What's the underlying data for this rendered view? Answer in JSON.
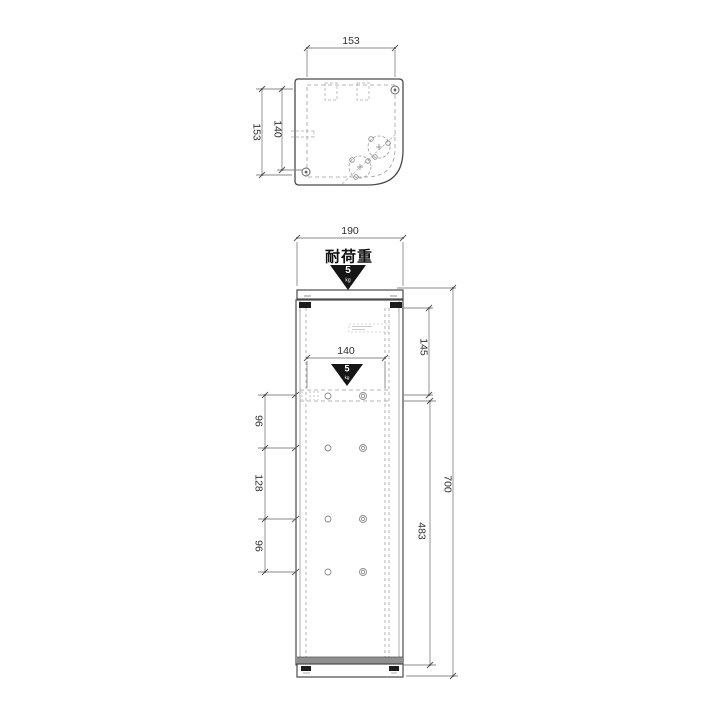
{
  "plan_view": {
    "dim_top_width": "153",
    "dim_left_depth": "153",
    "dim_left_hole_pitch": "140"
  },
  "front_view": {
    "dim_width": "190",
    "dim_shelf_width": "140",
    "dim_top_section": "145",
    "dim_total_height": "700",
    "dim_lower_section": "483",
    "dim_pitch_chain": [
      "96",
      "128",
      "96"
    ]
  },
  "load_badge": {
    "label": "耐荷重",
    "value": "5",
    "unit": "kg"
  },
  "colors": {
    "outline": "#4a4a4a",
    "dimension_line": "#8a8a8a",
    "hidden_line": "#9e9e9e",
    "badge": "#151515",
    "background": "#ffffff"
  }
}
